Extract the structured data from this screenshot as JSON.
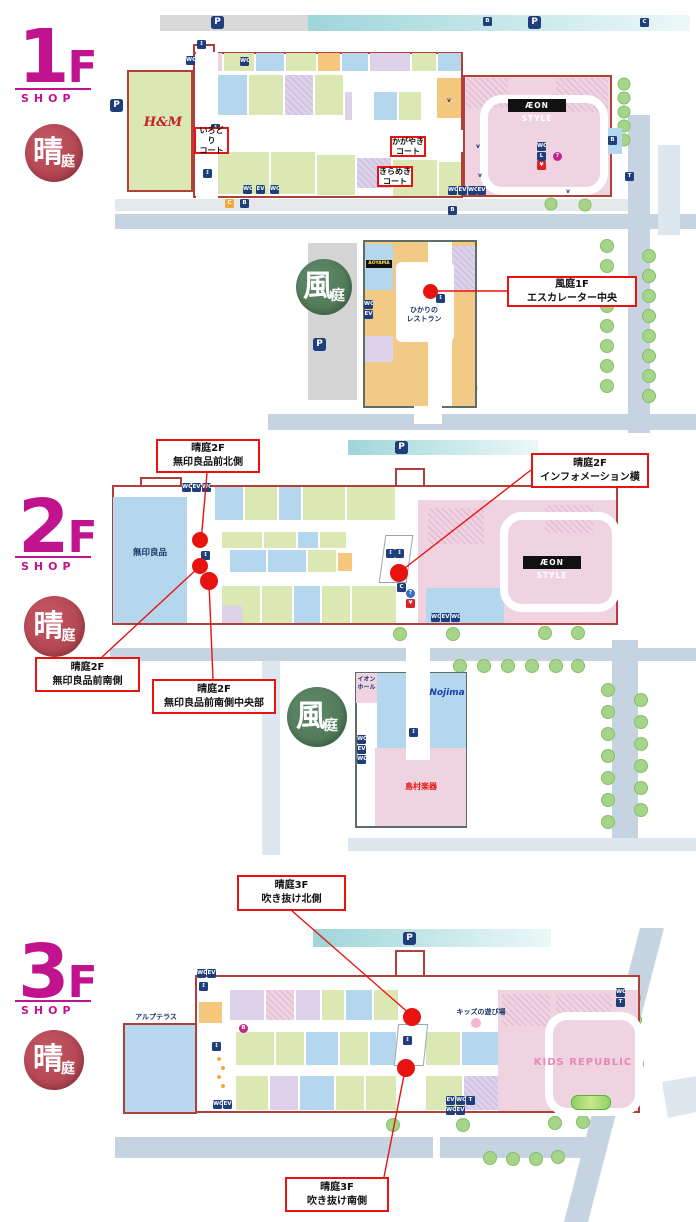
{
  "palette": {
    "magenta": "#c2138f",
    "accent_red": "#e8130e",
    "badge_crimson": "#ad404c",
    "badge_green": "#4f7a58",
    "navy": "#1e3e7c",
    "cell_green": "#dce8b4",
    "cell_blue": "#b4d7ee",
    "cell_pink": "#f0d3e1",
    "cell_lavender": "#ddd2ea",
    "cell_orange": "#f5c87e",
    "road": "#c6d4e2",
    "teal_strip": "#9fd6d9",
    "parking_gray": "#d9d9d9",
    "tree": "#a6d589",
    "outline_red": "#b0413a",
    "outline_green": "#5d6f64"
  },
  "icons": {
    "parking": "P",
    "toilet": "WC",
    "escalator": "↕",
    "elevator": "EV",
    "info": "?",
    "atm": "¥",
    "bus": "B",
    "car": "C",
    "bicycle": "B",
    "phone": "T",
    "kiosk": "C",
    "baby": "B",
    "locker": "L"
  },
  "floor1": {
    "label": "1F",
    "sub": "SHOP",
    "hare_badge": {
      "main": "晴",
      "sub": "庭"
    },
    "kaze_badge": {
      "main": "風",
      "sub": "庭"
    },
    "stores": {
      "hm": "H&M",
      "aeon_style": "ÆON STYLE",
      "aoyama": "AOYAMA",
      "hikari_1": "ひかりの",
      "hikari_2": "レストラン"
    },
    "callouts": {
      "irodori": [
        "いろどり",
        "コート"
      ],
      "kagayaki": [
        "かがやき",
        "コート"
      ],
      "kirameki": [
        "きらめき",
        "コート"
      ],
      "kaze_escalator": [
        "風庭1F",
        "エスカレーター中央"
      ]
    }
  },
  "floor2": {
    "label": "2F",
    "sub": "SHOP",
    "hare_badge": {
      "main": "晴",
      "sub": "庭"
    },
    "kaze_badge": {
      "main": "風",
      "sub": "庭"
    },
    "stores": {
      "muji": "無印良品",
      "aeon_style": "ÆON STYLE",
      "aeon_hall_1": "イオン",
      "aeon_hall_2": "ホール",
      "nojima": "Nojima",
      "shimamura": "島村楽器"
    },
    "callouts": {
      "north": [
        "晴庭2F",
        "無印良品前北側"
      ],
      "info_side": [
        "晴庭2F",
        "インフォメーション横"
      ],
      "south": [
        "晴庭2F",
        "無印良品前南側"
      ],
      "south_center": [
        "晴庭2F",
        "無印良品前南側中央部"
      ]
    }
  },
  "floor3": {
    "label": "3F",
    "sub": "SHOP",
    "hare_badge": {
      "main": "晴",
      "sub": "庭"
    },
    "stores": {
      "alp_terrace": "アルプテラス",
      "kids_play": "キッズの遊び場",
      "kids_republic": "KIDS REPUBLIC"
    },
    "callouts": {
      "north": [
        "晴庭3F",
        "吹き抜け北側"
      ],
      "south": [
        "晴庭3F",
        "吹き抜け南側"
      ]
    }
  }
}
